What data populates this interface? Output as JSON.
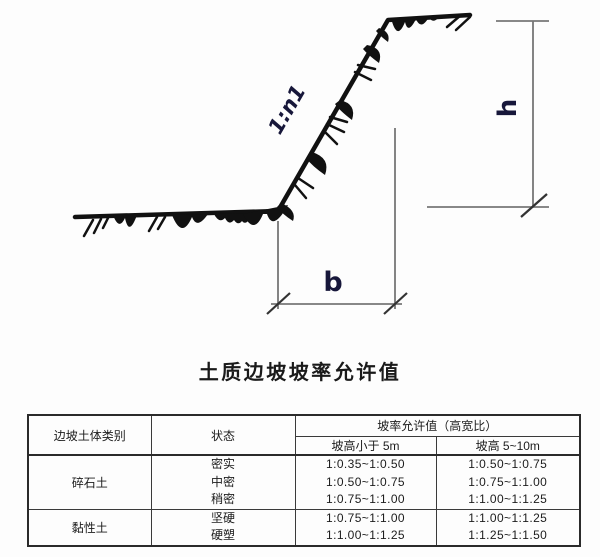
{
  "figure": {
    "slope_ratio_label": "1:n1",
    "height_label": "h",
    "base_label": "b"
  },
  "table": {
    "title": "土质边坡坡率允许值",
    "headers": {
      "category": "边坡土体类别",
      "state": "状态",
      "ratio_group": "坡率允许值（高宽比）",
      "col_lt5": "坡高小于 5m",
      "col_5to10": "坡高 5~10m"
    },
    "groups": [
      {
        "category": "碎石土",
        "states": [
          "密实",
          "中密",
          "稍密"
        ],
        "lt5": [
          "1:0.35~1:0.50",
          "1:0.50~1:0.75",
          "1:0.75~1:1.00"
        ],
        "h5to10": [
          "1:0.50~1:0.75",
          "1:0.75~1:1.00",
          "1:1.00~1:1.25"
        ]
      },
      {
        "category": "黏性土",
        "states": [
          "坚硬",
          "硬塑"
        ],
        "lt5": [
          "1:0.75~1:1.00",
          "1:1.00~1:1.25"
        ],
        "h5to10": [
          "1:1.00~1:1.25",
          "1:1.25~1:1.50"
        ]
      }
    ]
  },
  "colors": {
    "ink": "#111111",
    "dimension_line": "#777777",
    "tick": "#333333",
    "label": "#17173a",
    "table_border": "#2b2b2b"
  }
}
